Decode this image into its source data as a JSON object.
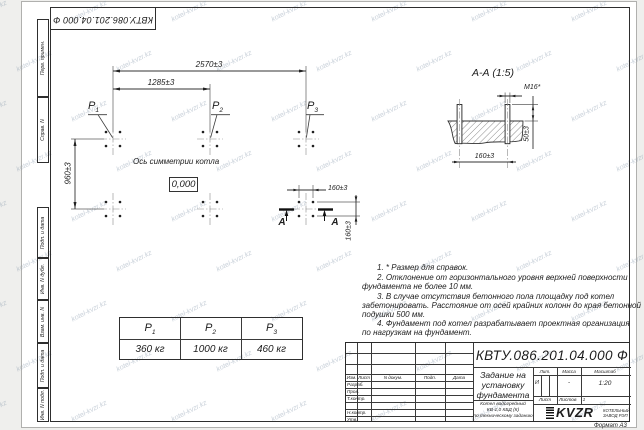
{
  "doc_number": "КВТУ.086.201.04.000  Ф",
  "frame_strips": {
    "perv_primen": "Перв. примен.",
    "sprav_n": "Справ. N",
    "podp_data_1": "Подп. и дата",
    "inv_dubl": "Инв. N дубл.",
    "vzam_inv": "Взам. инв. N",
    "podp_data_2": "Подп. и дата",
    "inv_podl": "Инв. N подл."
  },
  "plan": {
    "dim_2570": "2570±3",
    "dim_1285": "1285±3",
    "dim_960": "960±3",
    "dim_160_h": "160±3",
    "dim_160_v": "160±3",
    "load_labels": [
      {
        "base": "P",
        "sub": "1"
      },
      {
        "base": "P",
        "sub": "2"
      },
      {
        "base": "P",
        "sub": "3"
      }
    ],
    "axis_label": "Ось симметрии котла",
    "elevation_mark": "0,000",
    "section_letter_left": "А",
    "section_letter_right": "А"
  },
  "section_view": {
    "title": "А-А (1:5)",
    "thread_label": "М16*",
    "dim_50": "50±3",
    "dim_160": "160±3"
  },
  "loads_table": {
    "headers": [
      {
        "base": "P",
        "sub": "1"
      },
      {
        "base": "P",
        "sub": "2"
      },
      {
        "base": "P",
        "sub": "3"
      }
    ],
    "values": [
      "360  кг",
      "1000  кг",
      "460  кг"
    ]
  },
  "notes": {
    "line1": "1.  * Размер для справок.",
    "line2": "2.  Отклонение от горизонтального уровня верхней поверхности",
    "line3": "фундамента не более 10 мм.",
    "line4": "3.  В случае отсутствия бетонного пола площадку под котел",
    "line5": "забетонировать. Расстояние от осей крайних колонн до края бетонной",
    "line6": "подушки 500 мм.",
    "line7": "4.  Фундамент под котел разрабатывает проектная организация",
    "line8": "по нагрузкам на фундамент."
  },
  "title_block": {
    "title_line1": "Задание на",
    "title_line2": "установку",
    "title_line3": "фундамента",
    "product_line1": "Котел водогрейный",
    "product_line2": "КВ-1,0 КБД (К)",
    "product_line3": "по техническому заданию",
    "col_izm": "Изм.",
    "col_list": "Лист",
    "col_ndoc": "N докум.",
    "col_podp": "Подп.",
    "col_data": "Дата",
    "row_razrab": "Разраб.",
    "row_prov": "Пров.",
    "row_tkontr": "Т.контр.",
    "row_nkontr": "Н.контр.",
    "row_utv": "Утв.",
    "lit_header": "Лит.",
    "mass_header": "Масса",
    "scale_header": "Масштаб",
    "lit_value": "И",
    "mass_value": "-",
    "scale_value": "1:20",
    "sheet_label": "Лист",
    "sheets_label": "Листов",
    "sheets_value": "1",
    "company_name": "KVZR",
    "company_line1": "КОТЕЛЬНЫЙ",
    "company_line2": "ЗАВОД РЭП",
    "format_label": "Формат А3"
  },
  "watermark": {
    "text": "kotel-kvzr.kz"
  }
}
